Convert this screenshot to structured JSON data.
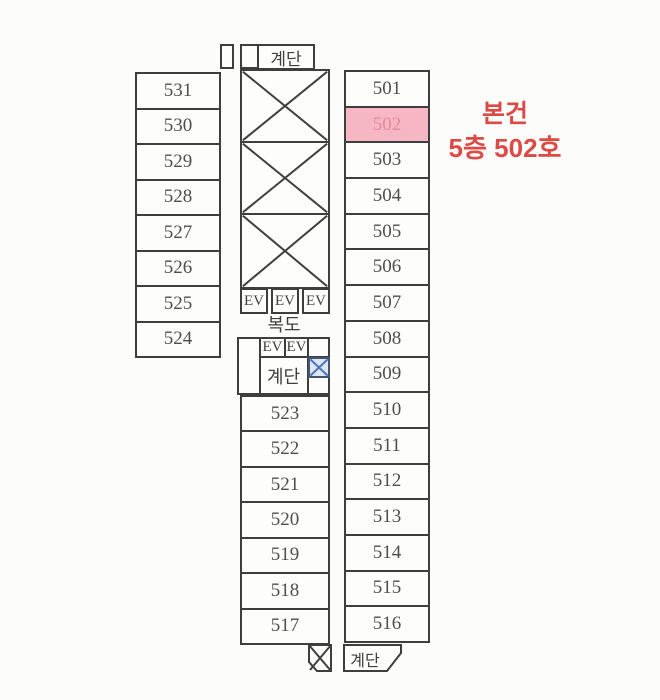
{
  "plan": {
    "labels": {
      "stair_top": "계단",
      "stair_mid": "계단",
      "stair_bottom": "계단",
      "corridor": "복도",
      "elevator": "EV"
    },
    "rooms": {
      "west_wing": [
        "531",
        "530",
        "529",
        "528",
        "527",
        "526",
        "525",
        "524"
      ],
      "east_wing": [
        "501",
        "502",
        "503",
        "504",
        "505",
        "506",
        "507",
        "508",
        "509",
        "510",
        "511",
        "512",
        "513",
        "514",
        "515",
        "516"
      ],
      "south_wing": [
        "523",
        "522",
        "521",
        "520",
        "519",
        "518",
        "517"
      ]
    },
    "highlight": {
      "room": "502",
      "fill": "#f6b6c3",
      "text_color": "#e48a9b"
    },
    "annotation": {
      "line1": "본건",
      "line2": "5층 502호",
      "color": "#dc4a46"
    },
    "colors": {
      "line": "#3e3e3e",
      "room_text": "#4e4e4e",
      "blue_x_stroke": "#4f74bd",
      "blue_x_fill": "#dce6f5"
    }
  }
}
